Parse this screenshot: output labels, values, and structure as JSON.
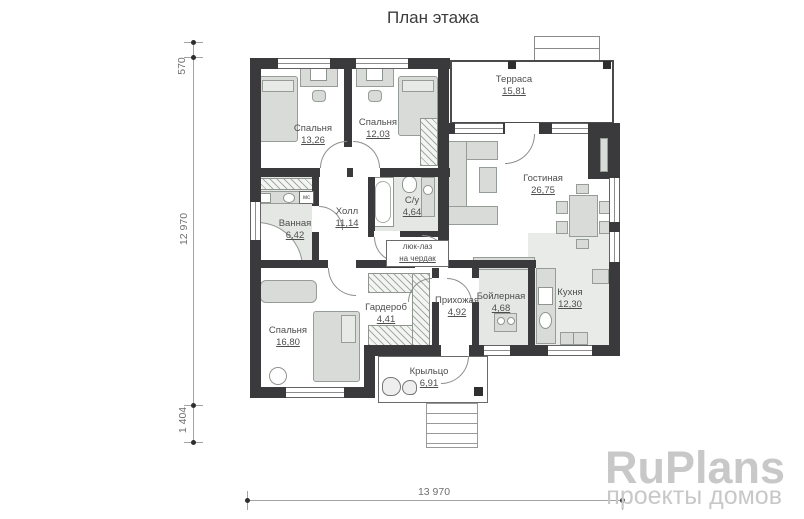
{
  "title": "План этажа",
  "rooms": [
    {
      "id": "terrace",
      "name": "Терраса",
      "area": "15,81"
    },
    {
      "id": "bedroom1",
      "name": "Спальня",
      "area": "13,26"
    },
    {
      "id": "bedroom2",
      "name": "Спальня",
      "area": "12,03"
    },
    {
      "id": "living",
      "name": "Гостиная",
      "area": "26,75"
    },
    {
      "id": "bathroom",
      "name": "Ванная",
      "area": "6,42"
    },
    {
      "id": "hall",
      "name": "Холл",
      "area": "11,14"
    },
    {
      "id": "wc",
      "name": "С/у",
      "area": "4,64"
    },
    {
      "id": "bedroom3",
      "name": "Спальня",
      "area": "16,80"
    },
    {
      "id": "wardrobe",
      "name": "Гардероб",
      "area": "4,41"
    },
    {
      "id": "entry",
      "name": "Прихожая",
      "area": "4,92"
    },
    {
      "id": "boiler",
      "name": "Бойлерная",
      "area": "4,68"
    },
    {
      "id": "kitchen",
      "name": "Кухня",
      "area": "12,30"
    },
    {
      "id": "porch",
      "name": "Крыльцо",
      "area": "6,91"
    }
  ],
  "annotations": {
    "attic_line1": "люк-лаз",
    "attic_line2": "на чердак",
    "washer_label": "мс"
  },
  "dimensions": {
    "left_top": "570",
    "left_middle": "12 970",
    "left_bottom": "1 404",
    "bottom": "13 970"
  },
  "watermark": {
    "brand": "RuPlans",
    "tagline": "проекты домов"
  },
  "colors": {
    "wall": "#3a3a3c",
    "furniture": "#d9dbd8",
    "floor_tint": "#e4e7e4",
    "dimension": "#6f6f6f",
    "watermark": "#c8c8c8"
  }
}
